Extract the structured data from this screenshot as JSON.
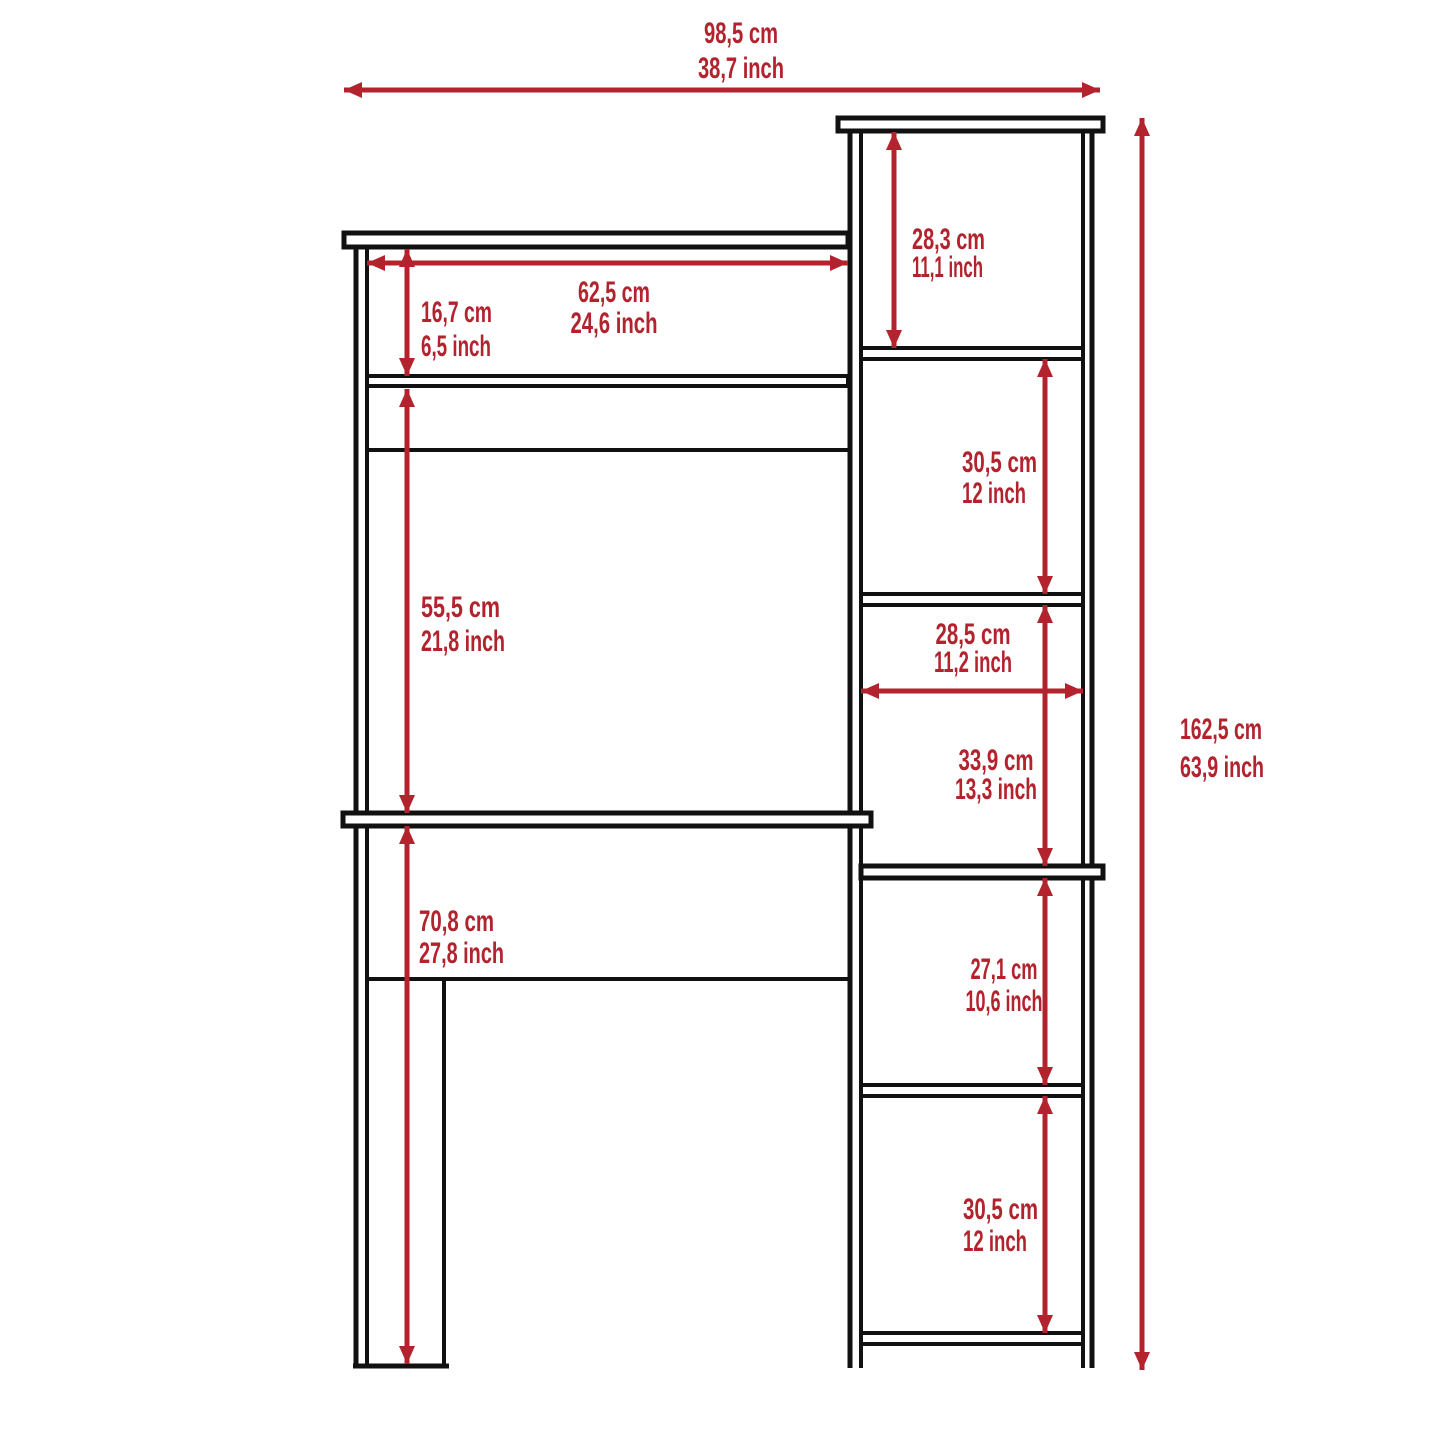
{
  "diagram_type": "furniture-dimension-drawing",
  "colors": {
    "dimension": "#B2232E",
    "outline": "#111111",
    "background": "#FFFFFF"
  },
  "dimensions": {
    "overall_width": {
      "cm": "98,5 cm",
      "inch": "38,7 inch"
    },
    "overall_height": {
      "cm": "162,5 cm",
      "inch": "63,9 inch"
    },
    "hutch_interior_width": {
      "cm": "62,5 cm",
      "inch": "24,6 inch"
    },
    "hutch_cubby_height": {
      "cm": "16,7 cm",
      "inch": "6,5 inch"
    },
    "hutch_opening_height": {
      "cm": "55,5 cm",
      "inch": "21,8 inch"
    },
    "under_desk_clearance": {
      "cm": "70,8 cm",
      "inch": "27,8 inch"
    },
    "tower_compartment_1": {
      "cm": "28,3 cm",
      "inch": "11,1 inch"
    },
    "tower_compartment_2": {
      "cm": "30,5 cm",
      "inch": "12 inch"
    },
    "tower_interior_width": {
      "cm": "28,5 cm",
      "inch": "11,2 inch"
    },
    "tower_compartment_3": {
      "cm": "33,9 cm",
      "inch": "13,3 inch"
    },
    "tower_compartment_4": {
      "cm": "27,1 cm",
      "inch": "10,6 inch"
    },
    "tower_compartment_5": {
      "cm": "30,5 cm",
      "inch": "12 inch"
    }
  }
}
